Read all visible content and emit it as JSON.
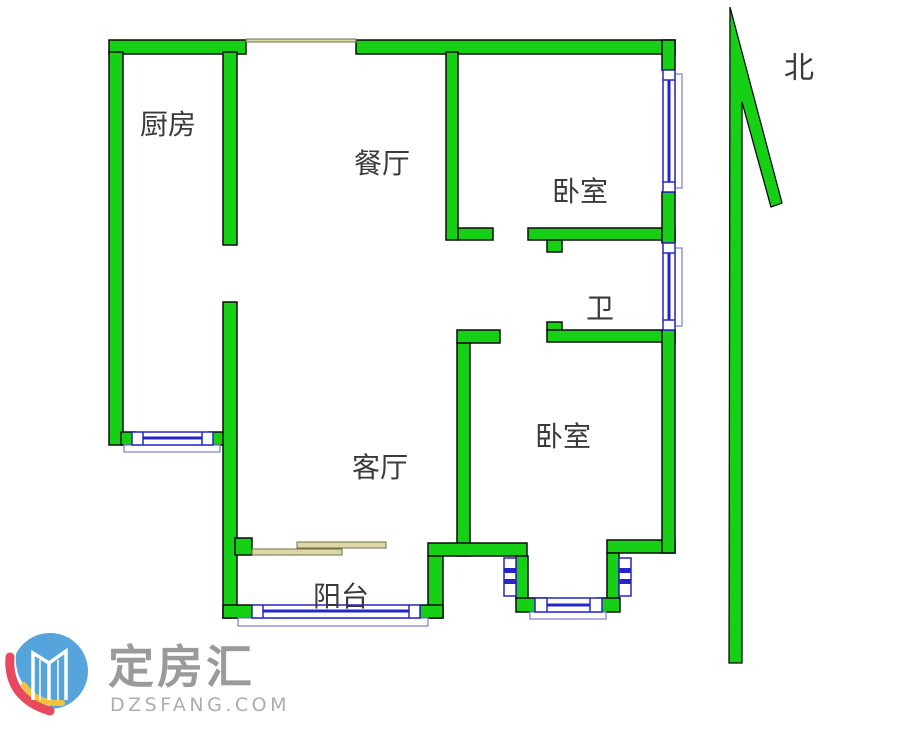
{
  "floorplan": {
    "rooms": {
      "kitchen": {
        "label": "厨房"
      },
      "dining": {
        "label": "餐厅"
      },
      "bedroom_top": {
        "label": "卧室"
      },
      "bathroom": {
        "label": "卫"
      },
      "living": {
        "label": "客厅"
      },
      "bedroom_bottom": {
        "label": "卧室"
      },
      "balcony": {
        "label": "阳台"
      }
    },
    "compass": {
      "label": "北"
    },
    "colors": {
      "wall_green": "#16d016",
      "wall_outline": "#0b0b0b",
      "window_blue": "#2525c8",
      "window_sill_blue": "#8585d6",
      "door_tan": "#ded7a8",
      "label_text": "#3a3a3a"
    }
  },
  "watermark": {
    "brand": "定房汇",
    "domain": "DZSFANG.COM",
    "logo_colors": {
      "circle_blue": "#55a4dc",
      "building_white": "#ffffff",
      "swoosh_red": "#e8495e",
      "swoosh_yellow": "#f2c43d"
    },
    "brand_text_color": "#9a9a9a",
    "domain_text_color": "#adadad"
  }
}
